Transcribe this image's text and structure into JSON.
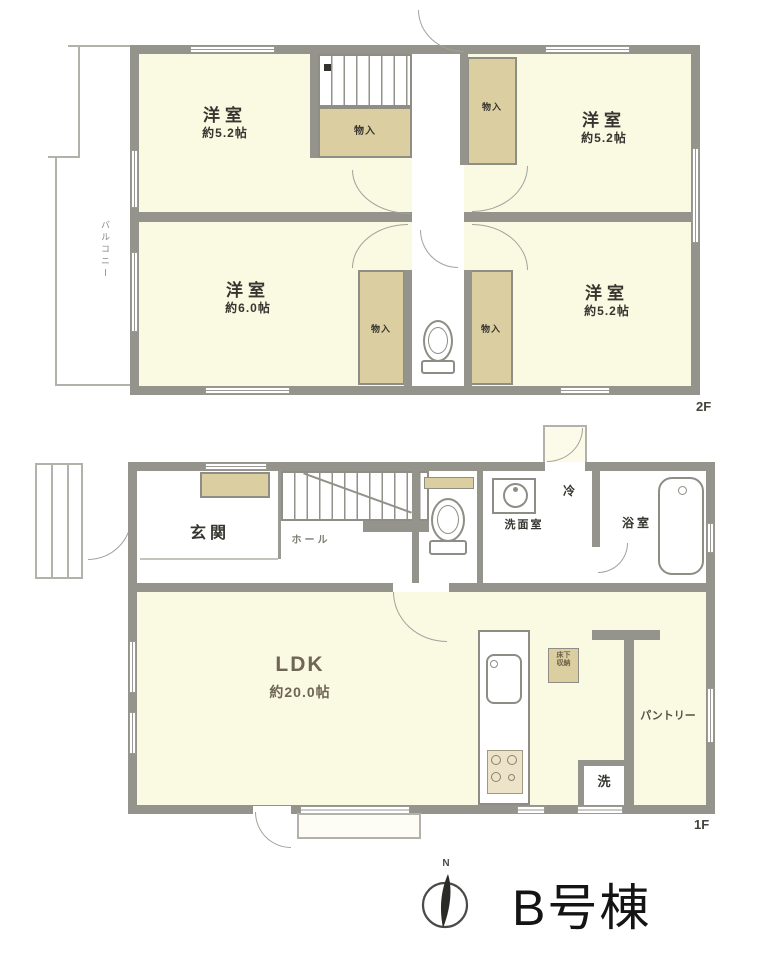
{
  "building": {
    "name_label": "B号棟"
  },
  "compass": {
    "north_label": "N"
  },
  "floor2": {
    "floor_label": "2F",
    "balcony_label": "バルコニー",
    "rooms": {
      "top_left": {
        "name": "洋室",
        "size": "約5.2帖"
      },
      "top_right": {
        "name": "洋室",
        "size": "約5.2帖"
      },
      "bottom_left": {
        "name": "洋室",
        "size": "約6.0帖"
      },
      "bottom_right": {
        "name": "洋室",
        "size": "約5.2帖"
      }
    },
    "closets": {
      "under_stairs": "物入",
      "top_right": "物入",
      "bottom_left": "物入",
      "bottom_right": "物入"
    }
  },
  "floor1": {
    "floor_label": "1F",
    "entrance_label": "玄関",
    "hall_label": "ホール",
    "washroom_label": "洗面室",
    "refrigerator_label": "冷",
    "bathroom_label": "浴室",
    "ldk": {
      "name": "LDK",
      "size": "約20.0帖"
    },
    "pantry_label": "パントリー",
    "laundry_label": "洗",
    "floor_storage": {
      "line1": "床下",
      "line2": "収納"
    }
  },
  "colors": {
    "wall": "#95948c",
    "room_fill": "#faf9e2",
    "closet_fill": "#dbcfa2"
  }
}
